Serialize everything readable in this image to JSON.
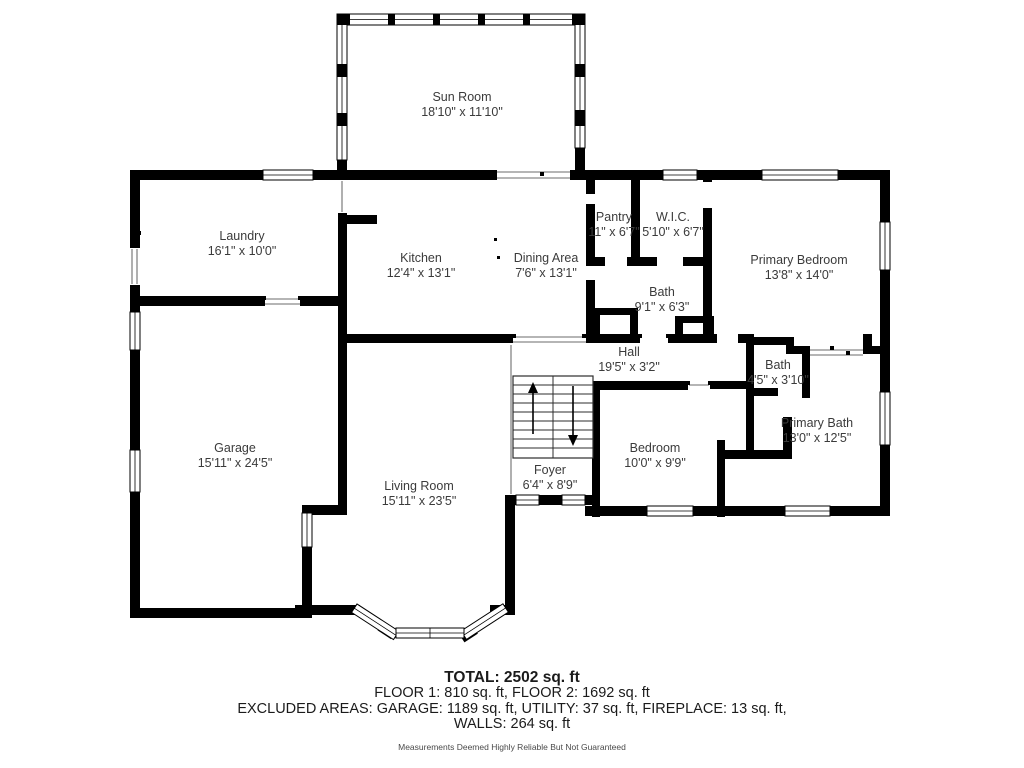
{
  "rooms": {
    "sun_room": {
      "name": "Sun Room",
      "dims": "18'10\" x 11'10\""
    },
    "laundry": {
      "name": "Laundry",
      "dims": "16'1\" x 10'0\""
    },
    "kitchen": {
      "name": "Kitchen",
      "dims": "12'4\" x 13'1\""
    },
    "dining": {
      "name": "Dining Area",
      "dims": "7'6\" x 13'1\""
    },
    "pantry": {
      "name": "Pantry",
      "dims": "11\" x 6'7\""
    },
    "wic": {
      "name": "W.I.C.",
      "dims": "5'10\" x 6'7\""
    },
    "primary_bedroom": {
      "name": "Primary Bedroom",
      "dims": "13'8\" x 14'0\""
    },
    "bath": {
      "name": "Bath",
      "dims": "9'1\" x 6'3\""
    },
    "hall": {
      "name": "Hall",
      "dims": "19'5\" x 3'2\""
    },
    "bath_small": {
      "name": "Bath",
      "dims": "4'5\" x 3'10\""
    },
    "primary_bath": {
      "name": "Primary Bath",
      "dims": "13'0\" x 12'5\""
    },
    "garage": {
      "name": "Garage",
      "dims": "15'11\" x 24'5\""
    },
    "living_room": {
      "name": "Living Room",
      "dims": "15'11\" x 23'5\""
    },
    "foyer": {
      "name": "Foyer",
      "dims": "6'4\" x 8'9\""
    },
    "bedroom": {
      "name": "Bedroom",
      "dims": "10'0\" x 9'9\""
    }
  },
  "summary": {
    "total": "TOTAL: 2502 sq. ft",
    "floors": "FLOOR 1: 810 sq. ft, FLOOR 2: 1692 sq. ft",
    "excluded": "EXCLUDED AREAS: GARAGE: 1189 sq. ft, UTILITY: 37 sq. ft, FIREPLACE: 13 sq. ft,",
    "walls": "WALLS: 264 sq. ft",
    "disclaimer": "Measurements Deemed Highly Reliable But Not Guaranteed"
  },
  "colors": {
    "wall": "#000000",
    "background": "#ffffff",
    "text": "#3b3b3b"
  }
}
